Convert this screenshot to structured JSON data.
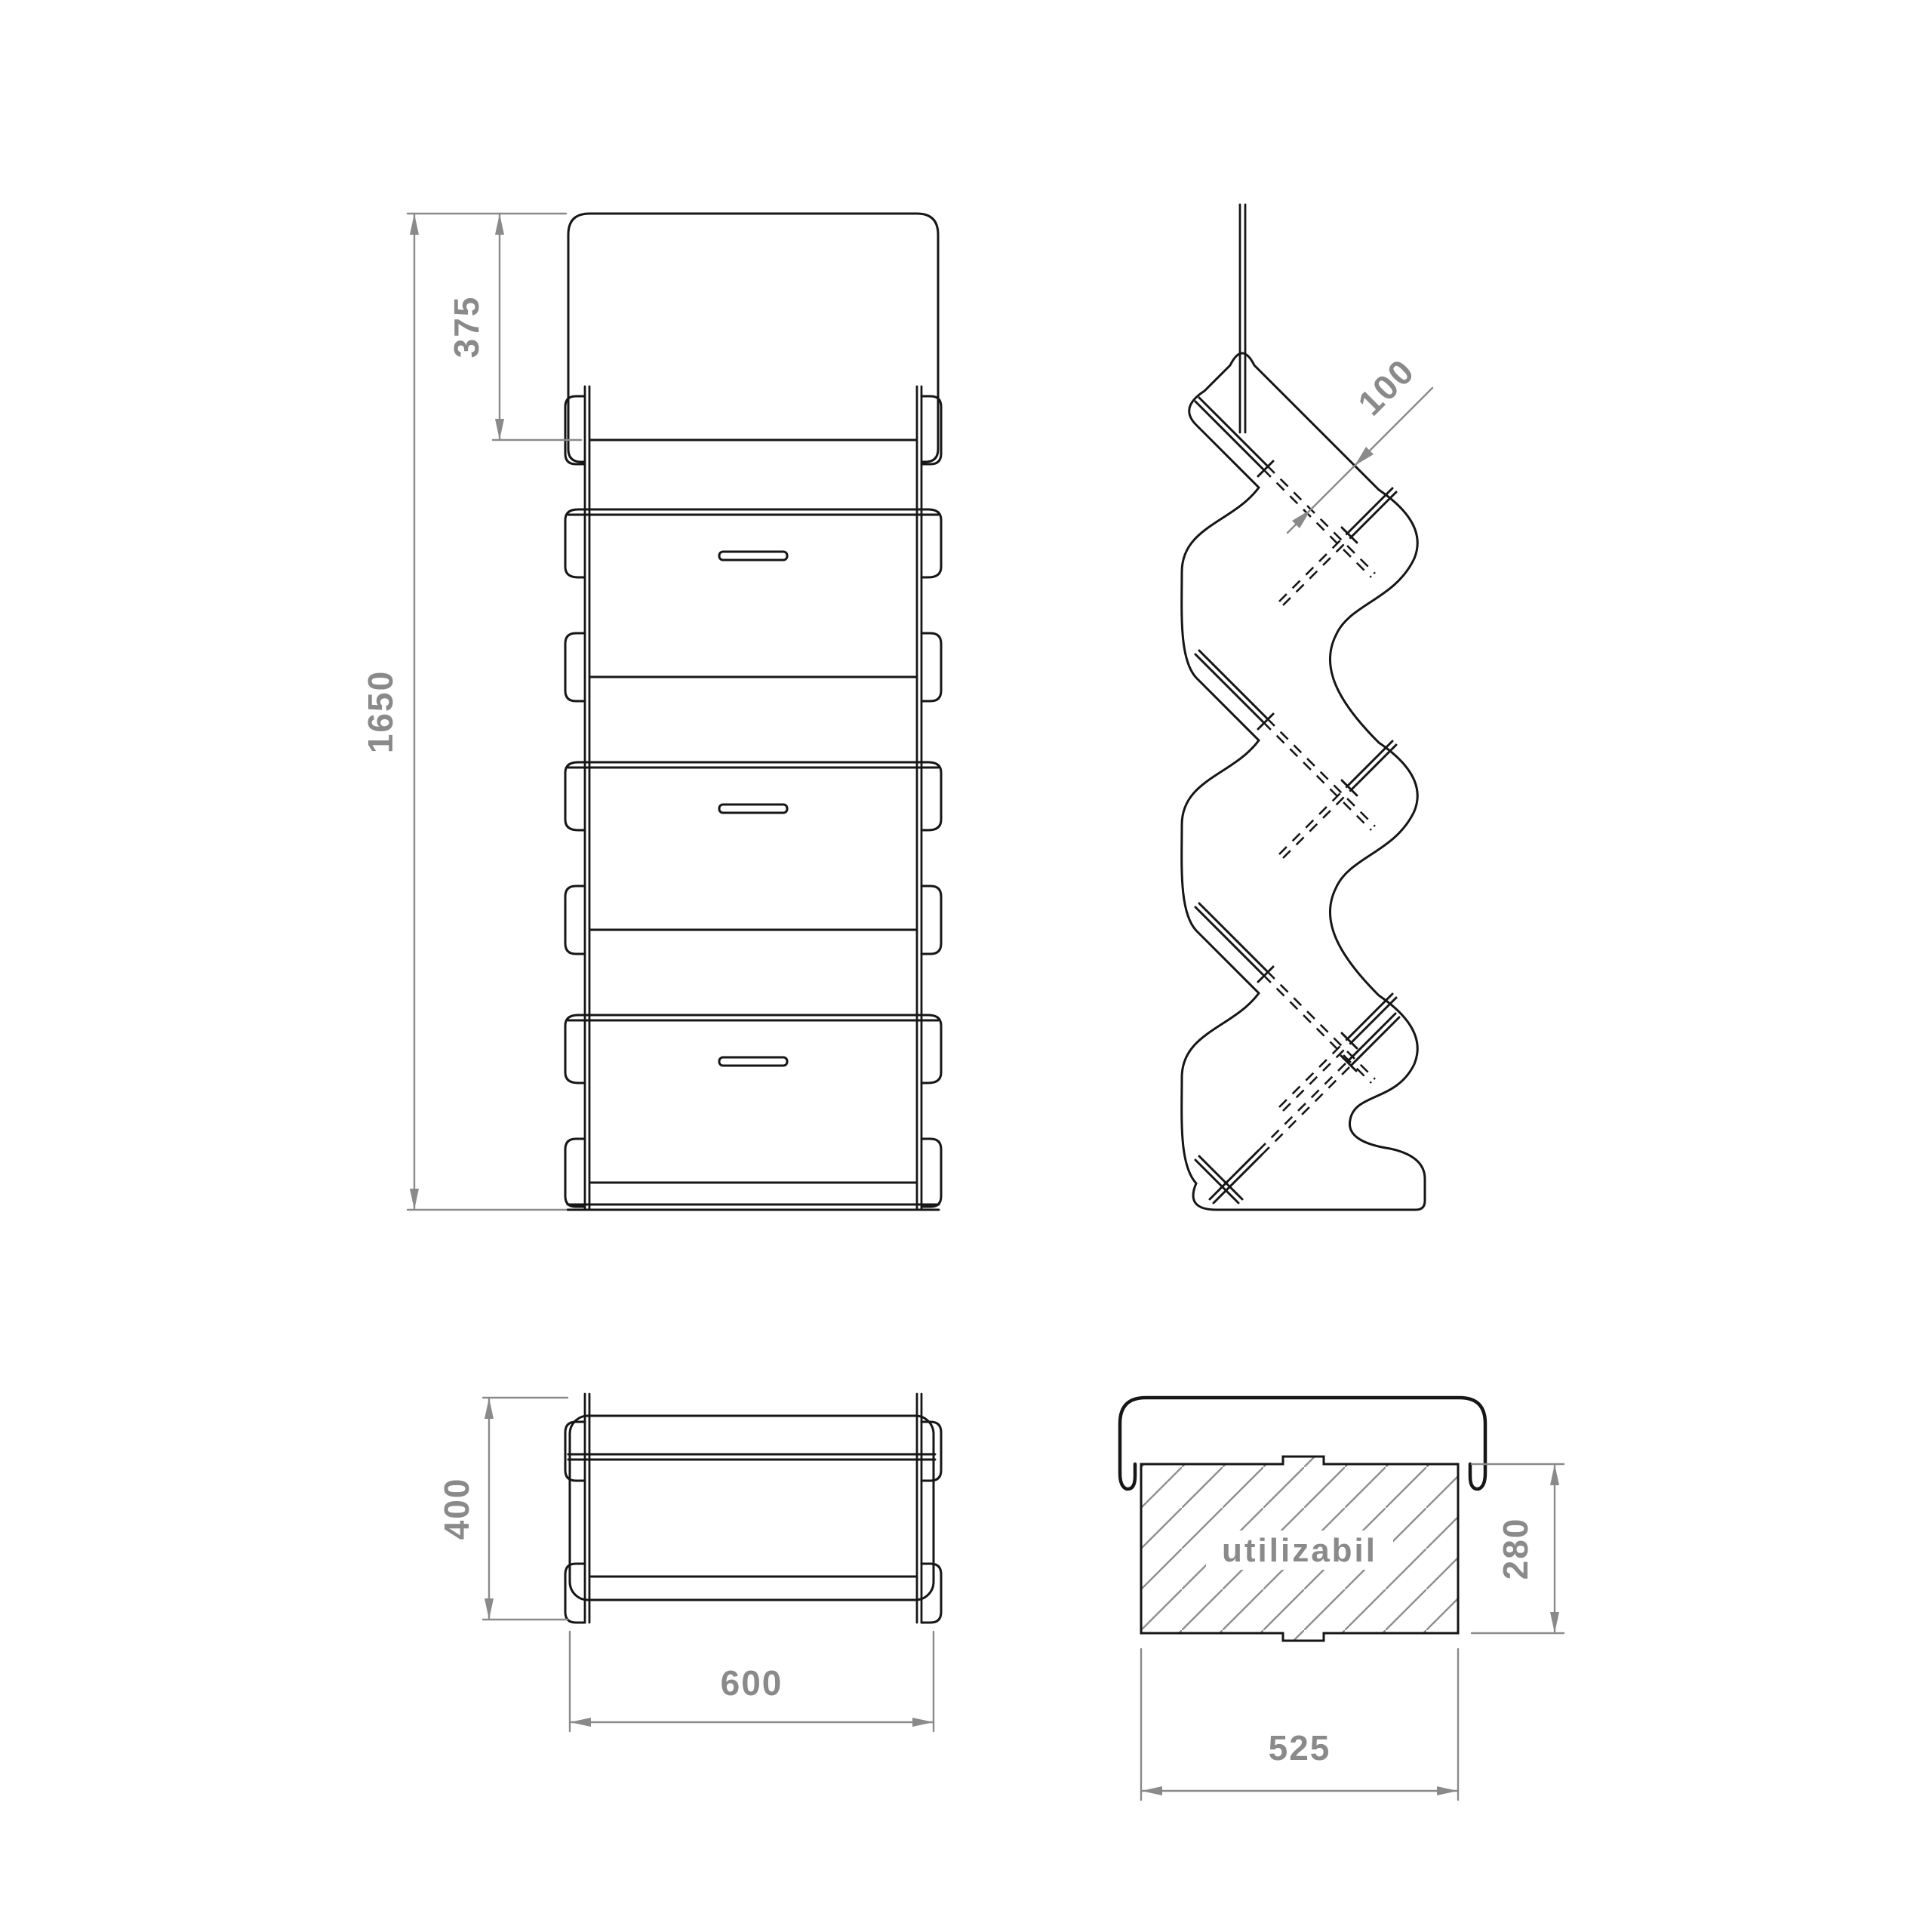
{
  "drawing_title": "wall shoe rack technical drawing",
  "colors": {
    "background": "#ffffff",
    "line": "#161616",
    "dimension": "#8a8a8a"
  },
  "views": {
    "front": {
      "name": "front view",
      "dim_total_height": "1650",
      "dim_top_offset": "375"
    },
    "side": {
      "name": "side view",
      "dim_pocket_opening": "100"
    },
    "top": {
      "name": "top view",
      "dim_depth": "400",
      "dim_width": "600"
    },
    "section": {
      "name": "usable space section",
      "usable_label": "utilizabil",
      "dim_usable_height": "280",
      "dim_usable_width": "525"
    }
  }
}
